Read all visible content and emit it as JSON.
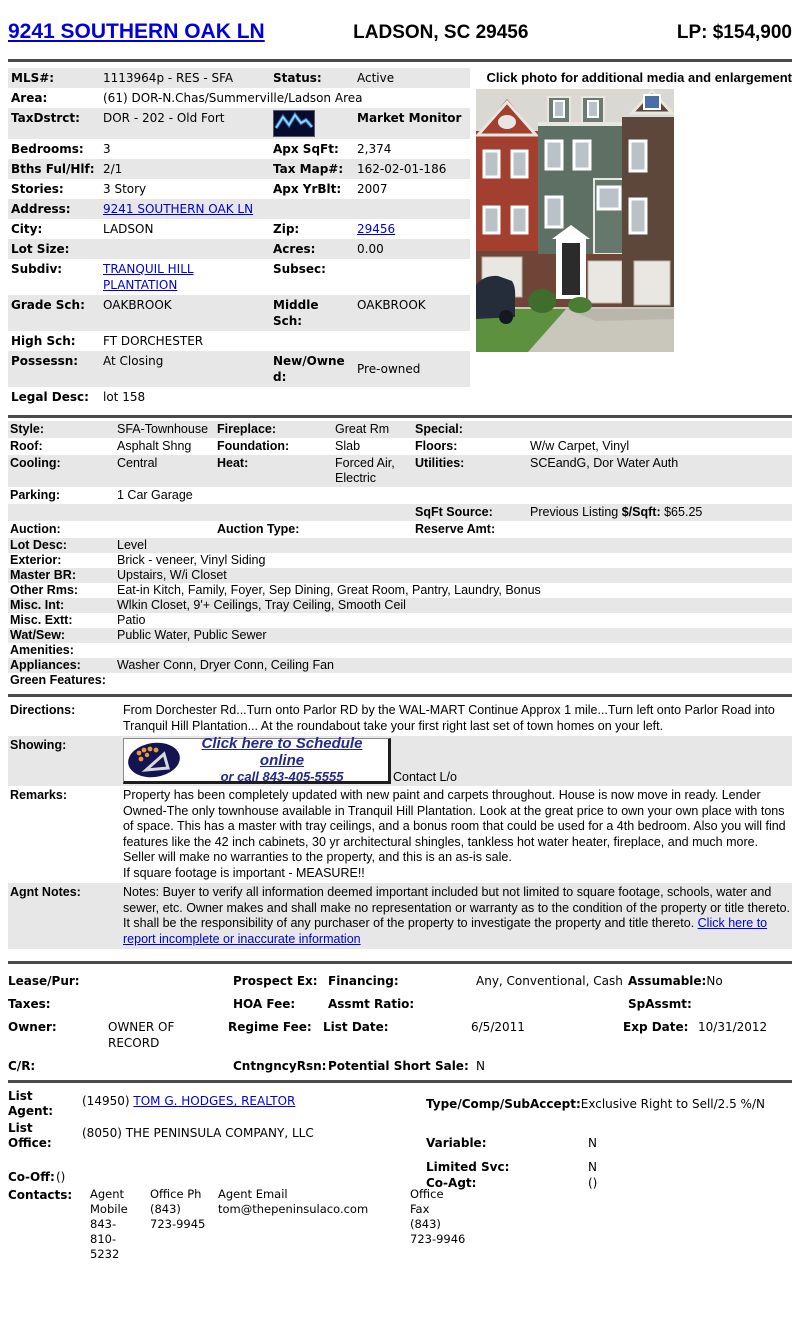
{
  "theme": {
    "link": "#0000dd",
    "row-gray": "#e7e7e7",
    "rule": "#4b4b4b"
  },
  "header": {
    "address": "9241 SOUTHERN OAK LN",
    "location": "LADSON, SC 29456",
    "price": "LP: $154,900"
  },
  "photo": {
    "caption": "Click photo for additional media and enlargement"
  },
  "info": {
    "mls_label": "MLS#:",
    "mls": "1113964p - RES - SFA",
    "status_label": "Status:",
    "status": "Active",
    "area_label": "Area:",
    "area": "(61) DOR-N.Chas/Summerville/Ladson Area",
    "taxdstrct_label": "TaxDstrct:",
    "taxdstrct": "DOR - 202 - Old Fort",
    "market_monitor": "Market Monitor",
    "bedrooms_label": "Bedrooms:",
    "bedrooms": "3",
    "apx_sqft_label": "Apx SqFt:",
    "apx_sqft": "2,374",
    "bths_label": "Bths Ful/Hlf:",
    "bths": "2/1",
    "tax_map_label": "Tax Map#:",
    "tax_map": "162-02-01-186",
    "stories_label": "Stories:",
    "stories": "3 Story",
    "apx_yrblt_label": "Apx YrBlt:",
    "apx_yrblt": "2007",
    "address_label": "Address:",
    "address": "9241 SOUTHERN OAK LN",
    "city_label": "City:",
    "city": "LADSON",
    "zip_label": "Zip:",
    "zip": "29456",
    "lot_size_label": "Lot Size:",
    "lot_size": "",
    "acres_label": "Acres:",
    "acres": "0.00",
    "subdiv_label": "Subdiv:",
    "subdiv": "TRANQUIL HILL PLANTATION",
    "subsec_label": "Subsec:",
    "subsec": "",
    "grade_sch_label": "Grade Sch:",
    "grade_sch": "OAKBROOK",
    "middle_sch_label": "Middle Sch:",
    "middle_sch": "OAKBROOK",
    "high_sch_label": "High Sch:",
    "high_sch": "FT DORCHESTER",
    "possessn_label": "Possessn:",
    "possessn": "At Closing",
    "new_owned_label": "New/Owned:",
    "new_owned": "Pre-owned",
    "legal_desc_label": "Legal Desc:",
    "legal_desc": "lot 158"
  },
  "features": {
    "style_label": "Style:",
    "style": "SFA-Townhouse",
    "fireplace_label": "Fireplace:",
    "fireplace": "Great Rm",
    "special_label": "Special:",
    "special": "",
    "roof_label": "Roof:",
    "roof": "Asphalt Shng",
    "foundation_label": "Foundation:",
    "foundation": "Slab",
    "floors_label": "Floors:",
    "floors": "W/w Carpet, Vinyl",
    "cooling_label": "Cooling:",
    "cooling": "Central",
    "heat_label": "Heat:",
    "heat": "Forced Air, Electric",
    "utilities_label": "Utilities:",
    "utilities": "SCEandG, Dor Water Auth",
    "parking_label": "Parking:",
    "parking": "1 Car Garage",
    "sqft_source_label": "SqFt Source:",
    "sqft_source": "Previous Listing",
    "per_sqft_label": "$/Sqft:",
    "per_sqft": "$65.25",
    "auction_label": "Auction:",
    "auction_type_label": "Auction Type:",
    "reserve_amt_label": "Reserve Amt:",
    "lot_desc_label": "Lot Desc:",
    "lot_desc": "Level",
    "exterior_label": "Exterior:",
    "exterior": "Brick - veneer, Vinyl Siding",
    "master_br_label": "Master BR:",
    "master_br": "Upstairs, W/i Closet",
    "other_rms_label": "Other Rms:",
    "other_rms": "Eat-in Kitch, Family, Foyer, Sep Dining, Great Room, Pantry, Laundry, Bonus",
    "misc_int_label": "Misc. Int:",
    "misc_int": "Wlkin Closet, 9'+ Ceilings, Tray Ceiling, Smooth Ceil",
    "misc_ext_label": "Misc. Extt:",
    "misc_ext": "Patio",
    "wat_sew_label": "Wat/Sew:",
    "wat_sew": "Public Water, Public Sewer",
    "amenities_label": "Amenities:",
    "amenities": "",
    "appliances_label": "Appliances:",
    "appliances": "Washer Conn, Dryer Conn, Ceiling Fan",
    "green_label": "Green Features:",
    "green": ""
  },
  "narrative": {
    "directions_label": "Directions:",
    "directions": "From Dorchester Rd...Turn onto Parlor RD by the WAL-MART Continue Approx 1 mile...Turn left onto Parlor Road into Tranquil Hill Plantation... At the roundabout take your first right last set of town homes on your left.",
    "showing_label": "Showing:",
    "showing_badge_line1": "Click here to Schedule online",
    "showing_badge_line2": "or call 843-405-5555",
    "showing_contact": "Contact L/o",
    "remarks_label": "Remarks:",
    "remarks": "Property has been completely updated with new paint and carpets throughout. House is now move in ready. Lender Owned-The only townhouse available in Tranquil Hill Plantation. Look at the great price to own your own place with tons of space. This has a master with tray ceilings, and a bonus room that could be used for a 4th bedroom. Also you will find features like the 42 inch cabinets, 30 yr architectural shingles, tankless hot water heater, fireplace, and much more. Seller will make no warranties to the property, and this is an as-is sale.",
    "remarks_line2": "If square footage is important - MEASURE!!",
    "agnt_notes_label": "Agnt Notes:",
    "agnt_notes": "Notes: Buyer to verify all information deemed important included but not limited to square footage, schools, water and sewer, etc. Owner makes and shall make no representation or warranty as to the condition of the property or title thereto. It shall be the responsibility of any purchaser of the property to investigate the property and title thereto.",
    "agnt_notes_link": "Click here to report incomplete or inaccurate information"
  },
  "financial": {
    "lease_pur_label": "Lease/Pur:",
    "prospect_ex_label": "Prospect Ex:",
    "financing_label": "Financing:",
    "financing": "Any, Conventional, Cash",
    "assumable_label": "Assumable:",
    "assumable": "No",
    "taxes_label": "Taxes:",
    "hoa_fee_label": "HOA Fee:",
    "assmt_ratio_label": "Assmt Ratio:",
    "spassmt_label": "SpAssmt:",
    "owner_label": "Owner:",
    "owner": "OWNER OF RECORD",
    "regime_fee_label": "Regime Fee:",
    "list_date_label": "List Date:",
    "list_date": "6/5/2011",
    "exp_date_label": "Exp Date:",
    "exp_date": "10/31/2012",
    "cr_label": "C/R:",
    "cntngncy_label": "CntngncyRsn:",
    "short_sale_label": "Potential Short Sale:",
    "short_sale": "N"
  },
  "agent": {
    "list_agent_label": "List Agent:",
    "list_agent_prefix": "(14950)",
    "list_agent_link": "TOM G. HODGES, REALTOR",
    "type_comp_label": "Type/Comp/SubAccept:",
    "type_comp": "Exclusive Right to Sell/2.5 %/N",
    "list_office_label": "List Office:",
    "list_office": "(8050) THE PENINSULA COMPANY, LLC",
    "variable_label": "Variable:",
    "variable": "N",
    "limited_svc_label": "Limited Svc:",
    "limited_svc": "N",
    "co_off_label": "Co-Off:",
    "co_off": "()",
    "co_agt_label": "Co-Agt:",
    "co_agt": "()",
    "contacts_label": "Contacts:",
    "contacts": {
      "col1_header": "Agent Mobile",
      "col1_value": "843-810-5232",
      "col2_header": "Office Ph",
      "col2_value": "(843) 723-9945",
      "col3_header": "Agent Email",
      "col3_value": "tom@thepeninsulaco.com",
      "col4_header": "Office Fax",
      "col4_value": "(843) 723-9946"
    }
  }
}
